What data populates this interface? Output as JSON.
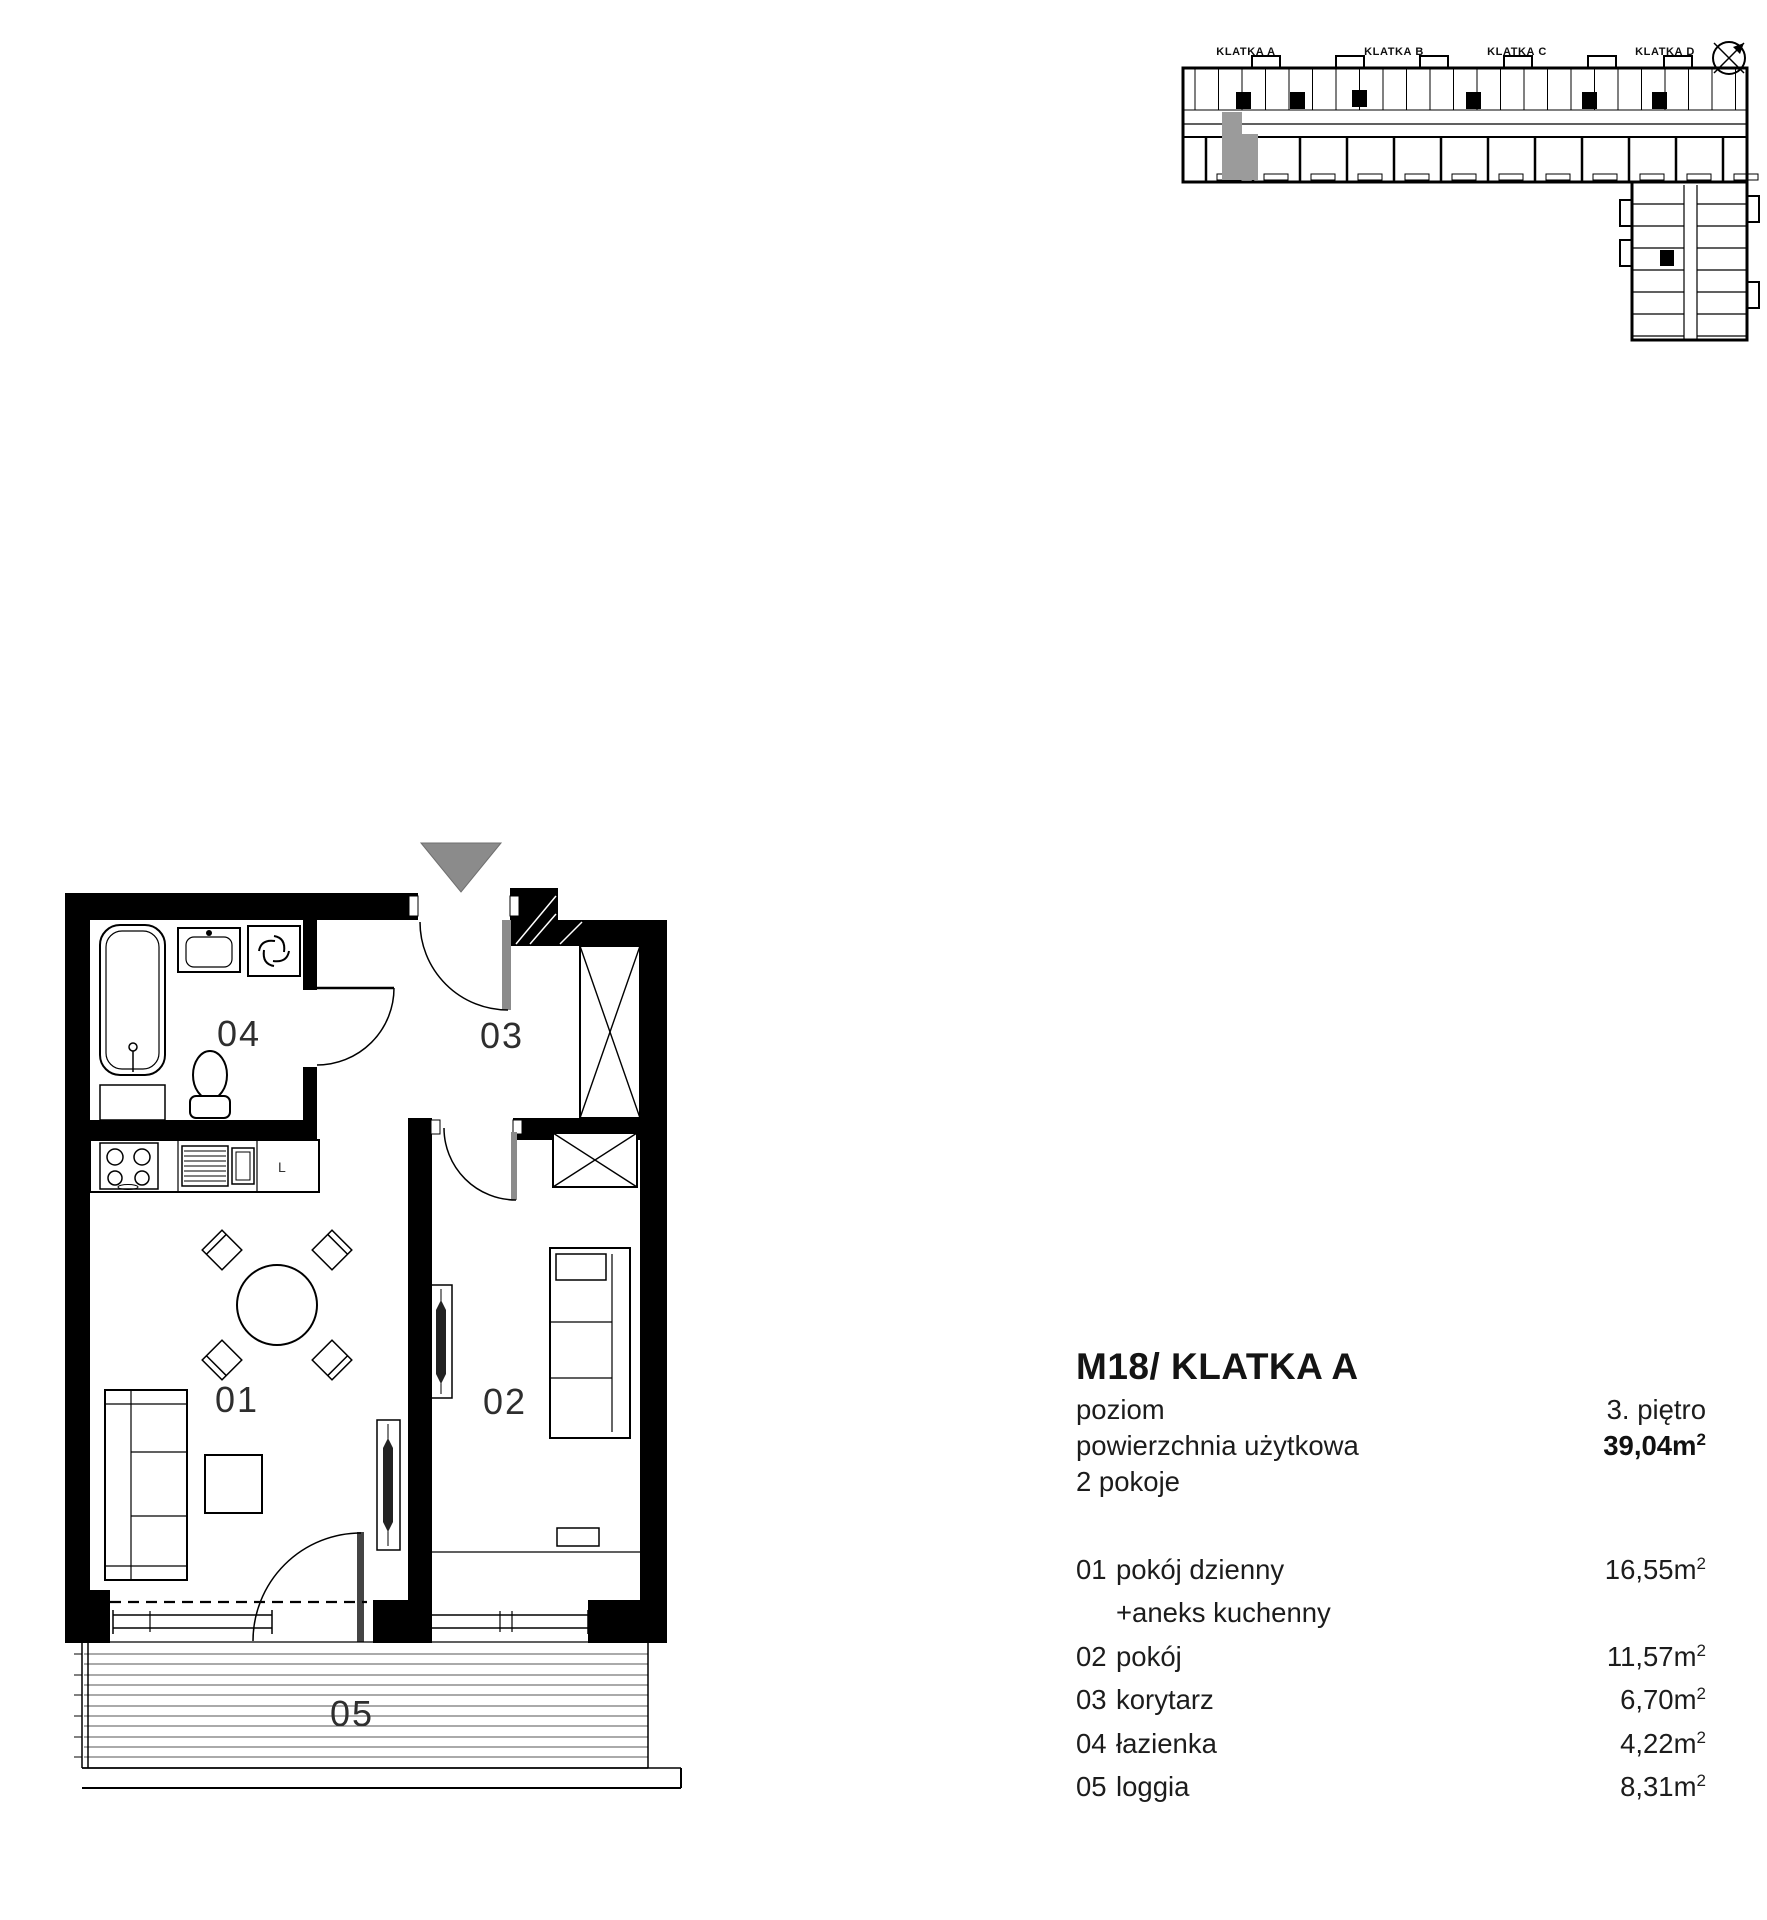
{
  "colors": {
    "line": "#000000",
    "text": "#1c1c1c",
    "door_leaf": "#8b8b8b",
    "entrance_marker": "#8b8b8b",
    "highlight_unit": "#9b9b9b"
  },
  "overview": {
    "labels": [
      "KLATKA A",
      "KLATKA B",
      "KLATKA C",
      "KLATKA D"
    ],
    "compass_icon": "compass-rose"
  },
  "plan": {
    "room_labels": {
      "r01": "01",
      "r02": "02",
      "r03": "03",
      "r04": "04",
      "r05": "05"
    },
    "kitchen_letter": "L"
  },
  "info": {
    "title": "M18/ KLATKA A",
    "sup": "2",
    "level_label": "poziom",
    "level_value": "3. piętro",
    "area_label": "powierzchnia użytkowa",
    "area_value": "39,04m",
    "rooms_label": "2 pokoje",
    "rooms": [
      {
        "num": "01",
        "name": "pokój dzienny",
        "area": "16,55m"
      },
      {
        "num": "",
        "name": "+aneks kuchenny",
        "area": ""
      },
      {
        "num": "02",
        "name": "pokój",
        "area": "11,57m"
      },
      {
        "num": "03",
        "name": "korytarz",
        "area": "6,70m"
      },
      {
        "num": "04",
        "name": "łazienka",
        "area": "4,22m"
      },
      {
        "num": "05",
        "name": "loggia",
        "area": "8,31m"
      }
    ]
  }
}
